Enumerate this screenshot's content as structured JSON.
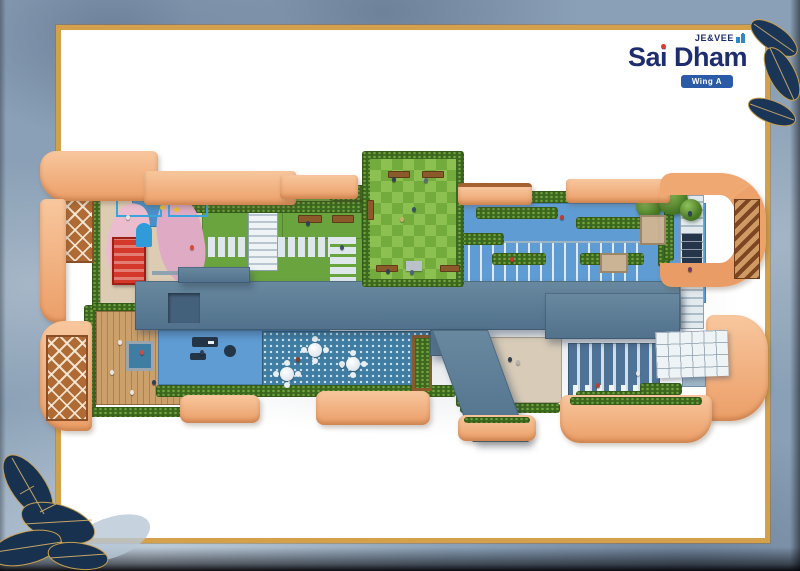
{
  "brand": {
    "parent_brand": "JE&VEE",
    "project_name": "Sai Dham",
    "wing_label": "Wing A"
  },
  "colors": {
    "logo_navy": "#1e2d6e",
    "logo_i_dot_red": "#e03c2d",
    "wing_badge_blue": "#2b5aa7",
    "frame_gold": "#d4a04a",
    "card_white": "#ffffff",
    "backdrop_blue_grey": "#8aa0b6",
    "corner_leaf_navy": "#18314f",
    "leaf_vein_gold": "#c8a050",
    "parapet_peach": "#f2ab79",
    "roof_slate_blue": "#5d7f9d",
    "deck_blue": "#5f9cd4",
    "hedge_green": "#3c681f",
    "lawn_green": "#6aa43f",
    "checker_lawn_light": "#8cc152",
    "checker_lawn_dark": "#73ac3c",
    "wood_deck_tan": "#c49a64",
    "cafe_tile_teal": "#3f7da3",
    "playground_floor_beige": "#ddccb4",
    "courtyard_beige": "#d8ccb8"
  },
  "plan": {
    "type": "rooftop-amenity-floor-plan",
    "areas": [
      "kids-play-area",
      "trellis-pergola",
      "stepping-stone-lawn",
      "garden-benches",
      "chess-pattern-lawn-garden",
      "hedge-maze-deck",
      "jogging-track",
      "tree-court",
      "yoga-wood-deck",
      "open-gym-deck",
      "outdoor-cafe-seating",
      "paved-courtyard",
      "cabana-lounge",
      "glass-canopy",
      "side-walkway",
      "peach-planter-boxes"
    ]
  }
}
